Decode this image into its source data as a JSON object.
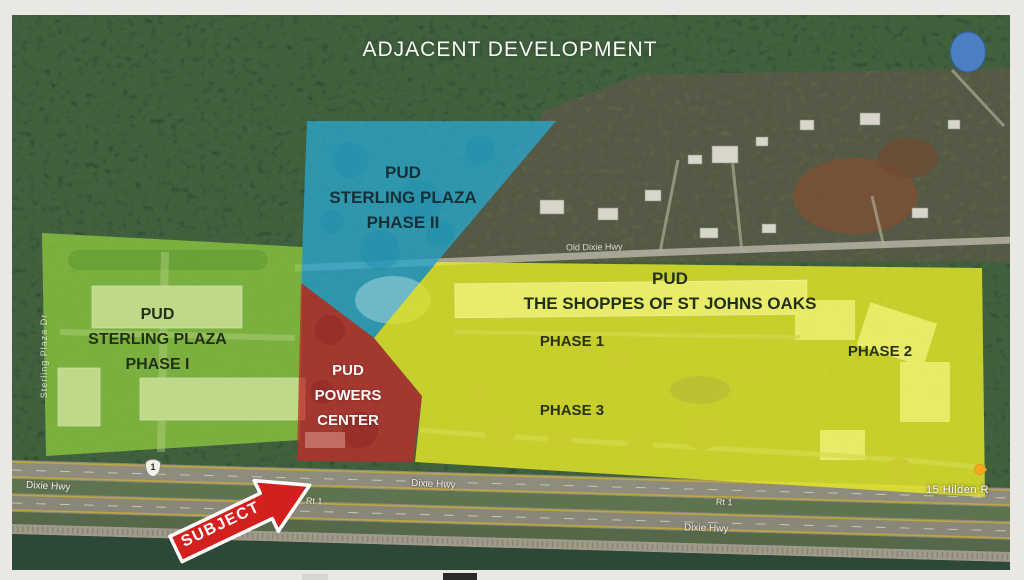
{
  "slide": {
    "title": "ADJACENT DEVELOPMENT"
  },
  "zones": {
    "sterling_plaza_phase2": {
      "name_line1": "PUD",
      "name_line2": "STERLING PLAZA",
      "name_line3": "PHASE II",
      "color": "#2ba4c8"
    },
    "sterling_plaza_phase1": {
      "name_line1": "PUD",
      "name_line2": "STERLING PLAZA",
      "name_line3": "PHASE I",
      "color": "#8dc63f"
    },
    "powers_center": {
      "name_line1": "PUD",
      "name_line2": "POWERS",
      "name_line3": "CENTER",
      "color": "#bf2d2c"
    },
    "shoppes_st_johns_oaks": {
      "name_line1": "PUD",
      "name_line2": "THE SHOPPES OF ST JOHNS OAKS",
      "color": "#e5e829",
      "phase1_label": "PHASE 1",
      "phase2_label": "PHASE 2",
      "phase3_label": "PHASE 3"
    }
  },
  "annotations": {
    "subject_label": "SUBJECT",
    "arrow_color": "#d3201f",
    "highlight_dot_color": "#4d7fc3"
  },
  "road_labels": {
    "old_dixie_hwy": "Old Dixie Hwy",
    "sterling_plaza_dr": "Sterling Plaza Dr",
    "dixie_hwy_left": "Dixie Hwy",
    "dixie_hwy_mid": "Dixie Hwy",
    "dixie_hwy_right": "Dixie Hwy",
    "rt1_mid": "Rt 1",
    "rt1_right": "Rt 1",
    "us_route_shield": "1",
    "address_label": "15 Hilden R"
  }
}
